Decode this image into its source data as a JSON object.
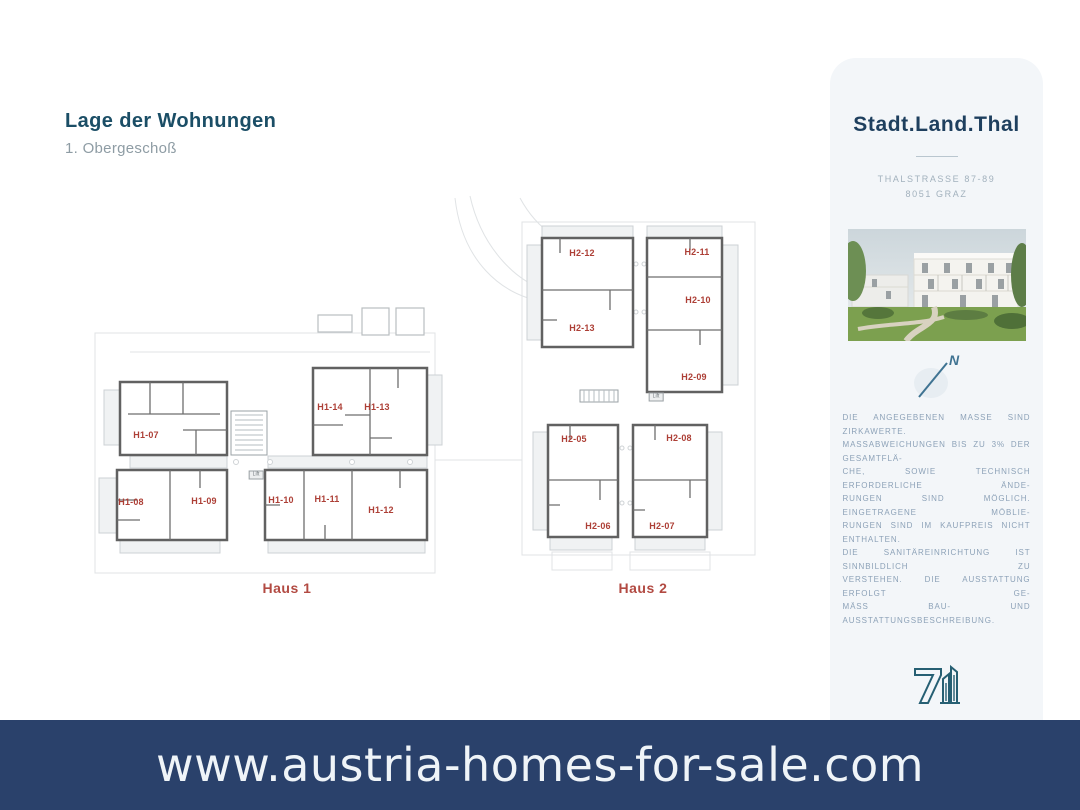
{
  "page": {
    "title": "Lage der Wohnungen",
    "subtitle": "1. Obergeschoß"
  },
  "plan": {
    "houses": [
      {
        "label": "Haus 1",
        "label_x": 287,
        "label_y": 588,
        "units": [
          {
            "label": "H1-07",
            "x": 146,
            "y": 435
          },
          {
            "label": "H1-08",
            "x": 131,
            "y": 502
          },
          {
            "label": "H1-09",
            "x": 204,
            "y": 501
          },
          {
            "label": "H1-10",
            "x": 281,
            "y": 500
          },
          {
            "label": "H1-11",
            "x": 327,
            "y": 499
          },
          {
            "label": "H1-12",
            "x": 381,
            "y": 510
          },
          {
            "label": "H1-13",
            "x": 377,
            "y": 407
          },
          {
            "label": "H1-14",
            "x": 330,
            "y": 407
          }
        ]
      },
      {
        "label": "Haus 2",
        "label_x": 643,
        "label_y": 588,
        "units": [
          {
            "label": "H2-12",
            "x": 582,
            "y": 253
          },
          {
            "label": "H2-13",
            "x": 582,
            "y": 328
          },
          {
            "label": "H2-11",
            "x": 697,
            "y": 252
          },
          {
            "label": "H2-10",
            "x": 698,
            "y": 300
          },
          {
            "label": "H2-09",
            "x": 694,
            "y": 377
          },
          {
            "label": "H2-05",
            "x": 574,
            "y": 439
          },
          {
            "label": "H2-08",
            "x": 679,
            "y": 438
          },
          {
            "label": "H2-06",
            "x": 598,
            "y": 526
          },
          {
            "label": "H2-07",
            "x": 662,
            "y": 526
          }
        ]
      }
    ],
    "lifts": [
      {
        "label": "Lift",
        "x": 256,
        "y": 475
      },
      {
        "label": "Lift",
        "x": 656,
        "y": 397
      }
    ],
    "unit_label_color": "#ad3f36",
    "haus_label_color": "#b24a42"
  },
  "sidebar": {
    "project_name": "Stadt.Land.Thal",
    "address_line1": "THALSTRASSE 87-89",
    "address_line2": "8051 GRAZ",
    "north_label": "N",
    "disclaimer_lines": [
      "DIE ANGEGEBENEN MASSE SIND ZIRKAWERTE.",
      "MASSABWEICHUNGEN BIS ZU 3% DER GESAMTFLÄ-",
      "CHE, SOWIE TECHNISCH ERFORDERLICHE ÄNDE-",
      "RUNGEN SIND MÖGLICH. EINGETRAGENE MÖBLIE-",
      "RUNGEN SIND IM KAUFPREIS NICHT ENTHALTEN.",
      "DIE SANITÄREINRICHTUNG IST SINNBILDLICH ZU",
      "VERSTEHEN. DIE AUSSTATTUNG ERFOLGT GE-",
      "MÄSS BAU- UND AUSSTATTUNGSBESCHREIBUNG."
    ],
    "company_name": "SIEBEN DÖRFER IMMOBILIEN",
    "company_address1": "BRÜCKENKOPFGASSE 5/1",
    "company_address2": "8020 GRAZ",
    "email": "OFFICE@7DOERFER.AT",
    "phone": "+43 1 9392929"
  },
  "footer": {
    "url": "www.austria-homes-for-sale.com",
    "background_color": "#2a416b",
    "text_color": "#eff4f8"
  }
}
